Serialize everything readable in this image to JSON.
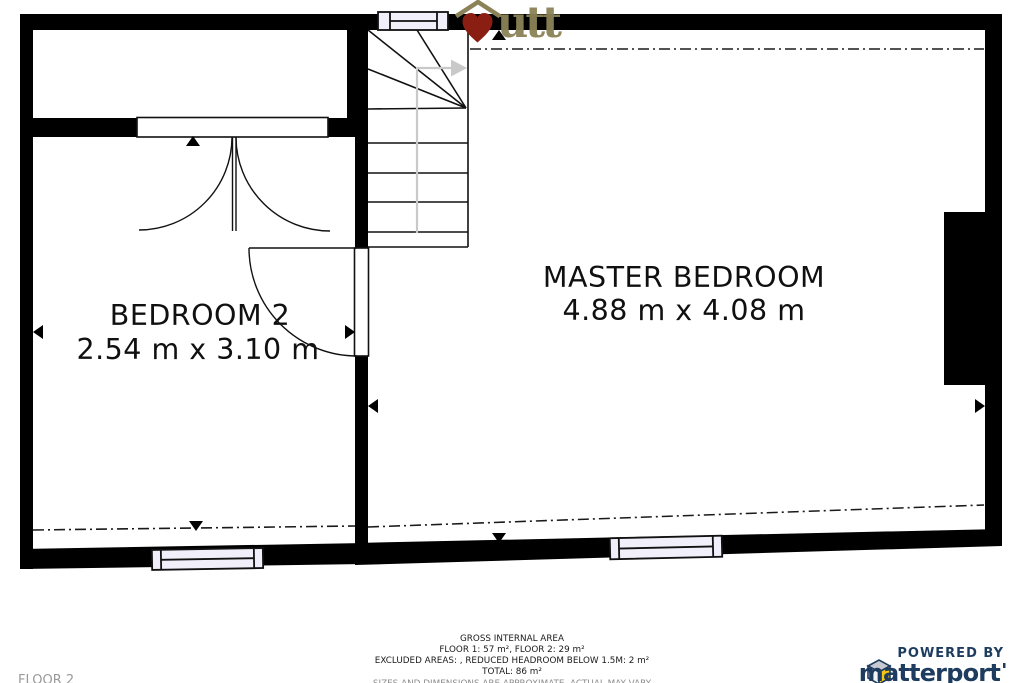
{
  "floorplan": {
    "floor_label": "FLOOR 2",
    "rooms": {
      "master": {
        "name": "MASTER BEDROOM",
        "dimensions": "4.88 m x 4.08 m"
      },
      "bedroom2": {
        "name": "BEDROOM 2",
        "dimensions": "2.54 m x 3.10 m"
      }
    }
  },
  "logo": {
    "text": "utt"
  },
  "footer": {
    "title": "GROSS INTERNAL AREA",
    "floors": "FLOOR 1: 57 m², FLOOR 2: 29 m²",
    "excluded": "EXCLUDED AREAS: , REDUCED HEADROOM BELOW 1.5M: 2 m²",
    "total": "TOTAL: 86 m²",
    "disclaimer": "SIZES AND DIMENSIONS ARE APPROXIMATE, ACTUAL MAY VARY"
  },
  "attribution": {
    "powered_by": "POWERED BY",
    "brand": "matterport"
  },
  "colors": {
    "heart_red": "#8b1e12",
    "logo_khaki": "#8b8257",
    "matterport_navy": "#1e3c5f",
    "cube_yellow": "#f6c513",
    "cube_gray": "#c7cbd1",
    "cube_light": "#f2f3f5",
    "walkline_gray": "#c9c9c9",
    "window_fill": "#f0effa"
  }
}
